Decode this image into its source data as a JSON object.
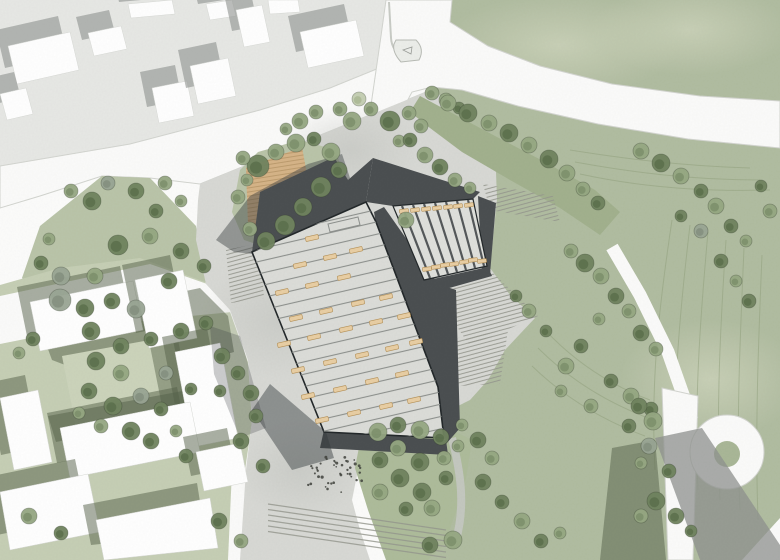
{
  "meta": {
    "description": "Architectural site plan rendering: stepped-roof building with bench-dotted roof terraces, striped courtyard, plazas, lawns, roads, cul-de-sac and context buildings",
    "visible_text": []
  },
  "palette": {
    "bg": "#fcfcfb",
    "block": "#e7e8e5",
    "road": "#fbfbfa",
    "road_edge": "#d3d5d0",
    "plaza": "#d8d9d5",
    "lawn": "#b1bda1",
    "park": "#bac5a9",
    "grass_low": "#c6cfb5",
    "court_grass": "#ccd4bb",
    "berm": "#a2b18e",
    "island": "#aebc9b",
    "building_white": "#ffffff",
    "building_edge": "#d8dad6",
    "shadow_pave": "#8f928f",
    "shadow_grass": "#556149",
    "wall_dark": "#4b4f51",
    "wall_shadow": "#34393b",
    "roof": "#dcddd9",
    "roof_line": "#8e918e",
    "court_floor": "#dfe0dc",
    "stripe": "#54585a",
    "bench": "#e9cfa4",
    "bench_edge": "#b69157",
    "deck": "#d6b488",
    "deck_line": "#bd9c6e",
    "steps_line": "#95978e",
    "contour": "#93a27f",
    "culdesac_center": "#a9b797",
    "dots": "#3f423c",
    "path_gray": "#c6c9c3",
    "outline": "#23282a",
    "tree": [
      "#c4ceb2",
      "#96a883",
      "#70845f",
      "#9aa695"
    ],
    "tree_core": [
      "#aab893",
      "#7c8f6a",
      "#5a6e4b",
      "#838f7e"
    ]
  },
  "context_buildings": {
    "top": [
      "8,46 70,32 79,70 17,84",
      "0,94 26,88 33,114 7,120",
      "88,33 121,26 127,49 94,56",
      "128,4 172,0 175,14 131,18",
      "152,88 187,81 194,116 159,123",
      "190,66 228,58 236,96 198,104",
      "206,4 232,0 236,16 210,20",
      "236,10 262,5 270,42 244,47",
      "300,32 356,20 364,56 308,68",
      "268,0 298,0 300,12 270,14"
    ],
    "bottom": [
      "30,302 133,281 143,330 40,351",
      "135,280 183,270 197,338 149,348",
      "175,352 220,343 238,438 193,447",
      "60,428 190,402 200,452 70,478",
      "196,452 240,443 248,482 204,491",
      "0,398 38,390 52,462 14,470",
      "0,492 88,474 100,532 10,550",
      "96,520 210,498 218,548 104,560"
    ]
  },
  "courtyard_stripes": [
    [
      402,
      206,
      430,
      278
    ],
    [
      413,
      205,
      439,
      276
    ],
    [
      424,
      204,
      448,
      274
    ],
    [
      435,
      203,
      457,
      272
    ],
    [
      446,
      202,
      466,
      270
    ],
    [
      457,
      201,
      475,
      268
    ],
    [
      468,
      200,
      484,
      266
    ]
  ],
  "courtyard_benches": [
    [
      404,
      211
    ],
    [
      427,
      269
    ],
    [
      415,
      210
    ],
    [
      436,
      267
    ],
    [
      426,
      209
    ],
    [
      445,
      265
    ],
    [
      437,
      208
    ],
    [
      454,
      264
    ],
    [
      448,
      207
    ],
    [
      464,
      262
    ],
    [
      458,
      206
    ],
    [
      473,
      260
    ],
    [
      469,
      205
    ],
    [
      482,
      261
    ]
  ],
  "roof_benches": [
    [
      300,
      265
    ],
    [
      330,
      257
    ],
    [
      356,
      250
    ],
    [
      282,
      292
    ],
    [
      312,
      285
    ],
    [
      344,
      277
    ],
    [
      296,
      318
    ],
    [
      326,
      311
    ],
    [
      358,
      303
    ],
    [
      386,
      297
    ],
    [
      284,
      344
    ],
    [
      314,
      337
    ],
    [
      346,
      329
    ],
    [
      376,
      322
    ],
    [
      404,
      316
    ],
    [
      298,
      370
    ],
    [
      330,
      362
    ],
    [
      362,
      355
    ],
    [
      392,
      348
    ],
    [
      416,
      342
    ],
    [
      308,
      396
    ],
    [
      340,
      389
    ],
    [
      372,
      381
    ],
    [
      402,
      374
    ],
    [
      322,
      420
    ],
    [
      354,
      413
    ],
    [
      386,
      406
    ],
    [
      414,
      400
    ],
    [
      312,
      238
    ]
  ],
  "dots": {
    "cx": 332,
    "cy": 474,
    "rx": 34,
    "ry": 20,
    "count": 42,
    "seed": 7
  },
  "trees": [
    [
      258,
      166,
      11,
      2
    ],
    [
      243,
      158,
      7,
      1
    ],
    [
      276,
      152,
      8,
      1
    ],
    [
      296,
      143,
      9,
      1
    ],
    [
      314,
      139,
      7,
      2
    ],
    [
      331,
      152,
      9,
      1
    ],
    [
      339,
      170,
      8,
      2
    ],
    [
      321,
      187,
      10,
      2
    ],
    [
      303,
      207,
      9,
      2
    ],
    [
      285,
      225,
      10,
      2
    ],
    [
      266,
      241,
      9,
      2
    ],
    [
      250,
      229,
      7,
      1
    ],
    [
      238,
      197,
      7,
      1
    ],
    [
      247,
      180,
      6,
      1
    ],
    [
      352,
      121,
      9,
      1
    ],
    [
      371,
      109,
      7,
      1
    ],
    [
      390,
      121,
      10,
      2
    ],
    [
      409,
      113,
      7,
      1
    ],
    [
      421,
      126,
      7,
      1
    ],
    [
      399,
      141,
      6,
      1
    ],
    [
      359,
      99,
      7,
      0
    ],
    [
      340,
      109,
      7,
      1
    ],
    [
      300,
      121,
      8,
      1
    ],
    [
      286,
      129,
      6,
      1
    ],
    [
      316,
      112,
      7,
      1
    ],
    [
      410,
      140,
      7,
      2
    ],
    [
      425,
      155,
      8,
      1
    ],
    [
      440,
      167,
      8,
      2
    ],
    [
      455,
      180,
      7,
      1
    ],
    [
      470,
      188,
      6,
      1
    ],
    [
      446,
      100,
      7,
      1
    ],
    [
      459,
      108,
      6,
      2
    ],
    [
      406,
      220,
      8,
      1
    ],
    [
      448,
      103,
      8,
      1
    ],
    [
      468,
      113,
      9,
      2
    ],
    [
      489,
      123,
      8,
      1
    ],
    [
      509,
      133,
      9,
      2
    ],
    [
      529,
      145,
      8,
      1
    ],
    [
      549,
      159,
      9,
      2
    ],
    [
      567,
      173,
      8,
      1
    ],
    [
      583,
      189,
      7,
      1
    ],
    [
      432,
      93,
      7,
      1
    ],
    [
      598,
      203,
      7,
      2
    ],
    [
      60,
      300,
      11,
      3
    ],
    [
      85,
      308,
      9,
      2
    ],
    [
      112,
      301,
      8,
      2
    ],
    [
      136,
      309,
      9,
      3
    ],
    [
      95,
      276,
      8,
      1
    ],
    [
      61,
      276,
      9,
      3
    ],
    [
      41,
      263,
      7,
      2
    ],
    [
      118,
      245,
      10,
      2
    ],
    [
      150,
      236,
      8,
      1
    ],
    [
      92,
      201,
      9,
      2
    ],
    [
      71,
      191,
      7,
      1
    ],
    [
      108,
      183,
      7,
      3
    ],
    [
      136,
      191,
      8,
      2
    ],
    [
      165,
      183,
      7,
      1
    ],
    [
      181,
      201,
      6,
      1
    ],
    [
      49,
      239,
      6,
      1
    ],
    [
      156,
      211,
      7,
      2
    ],
    [
      181,
      251,
      8,
      2
    ],
    [
      204,
      266,
      7,
      2
    ],
    [
      169,
      281,
      8,
      2
    ],
    [
      91,
      331,
      9,
      2
    ],
    [
      121,
      346,
      8,
      2
    ],
    [
      151,
      339,
      7,
      2
    ],
    [
      181,
      331,
      8,
      2
    ],
    [
      206,
      323,
      7,
      2
    ],
    [
      222,
      356,
      8,
      2
    ],
    [
      238,
      373,
      7,
      2
    ],
    [
      220,
      391,
      6,
      2
    ],
    [
      96,
      361,
      9,
      2
    ],
    [
      121,
      373,
      8,
      1
    ],
    [
      89,
      391,
      8,
      2
    ],
    [
      113,
      406,
      9,
      2
    ],
    [
      141,
      396,
      8,
      3
    ],
    [
      161,
      409,
      7,
      2
    ],
    [
      131,
      431,
      9,
      2
    ],
    [
      101,
      426,
      7,
      1
    ],
    [
      151,
      441,
      8,
      2
    ],
    [
      176,
      431,
      6,
      1
    ],
    [
      186,
      456,
      7,
      2
    ],
    [
      79,
      413,
      6,
      1
    ],
    [
      166,
      373,
      7,
      3
    ],
    [
      191,
      389,
      6,
      2
    ],
    [
      33,
      339,
      7,
      2
    ],
    [
      19,
      353,
      6,
      1
    ],
    [
      251,
      393,
      8,
      2
    ],
    [
      256,
      416,
      7,
      2
    ],
    [
      241,
      441,
      8,
      2
    ],
    [
      263,
      466,
      7,
      2
    ],
    [
      29,
      516,
      8,
      1
    ],
    [
      61,
      533,
      7,
      2
    ],
    [
      219,
      521,
      8,
      2
    ],
    [
      241,
      541,
      7,
      1
    ],
    [
      378,
      432,
      9,
      1
    ],
    [
      398,
      425,
      8,
      2
    ],
    [
      420,
      430,
      9,
      1
    ],
    [
      441,
      437,
      8,
      2
    ],
    [
      398,
      448,
      8,
      1
    ],
    [
      380,
      460,
      8,
      2
    ],
    [
      420,
      462,
      9,
      2
    ],
    [
      444,
      458,
      7,
      1
    ],
    [
      400,
      478,
      9,
      2
    ],
    [
      380,
      492,
      8,
      1
    ],
    [
      422,
      492,
      9,
      2
    ],
    [
      446,
      478,
      7,
      2
    ],
    [
      432,
      508,
      8,
      1
    ],
    [
      406,
      509,
      7,
      2
    ],
    [
      458,
      446,
      6,
      1
    ],
    [
      462,
      425,
      6,
      1
    ],
    [
      453,
      540,
      9,
      1
    ],
    [
      430,
      545,
      8,
      2
    ],
    [
      478,
      440,
      8,
      2
    ],
    [
      492,
      458,
      7,
      1
    ],
    [
      483,
      482,
      8,
      2
    ],
    [
      502,
      502,
      7,
      2
    ],
    [
      522,
      521,
      8,
      1
    ],
    [
      541,
      541,
      7,
      2
    ],
    [
      560,
      533,
      6,
      1
    ],
    [
      585,
      263,
      9,
      2
    ],
    [
      601,
      276,
      8,
      1
    ],
    [
      571,
      251,
      7,
      1
    ],
    [
      616,
      296,
      8,
      2
    ],
    [
      629,
      311,
      7,
      1
    ],
    [
      599,
      319,
      6,
      1
    ],
    [
      641,
      333,
      8,
      2
    ],
    [
      656,
      349,
      7,
      1
    ],
    [
      581,
      346,
      7,
      2
    ],
    [
      566,
      366,
      8,
      1
    ],
    [
      611,
      381,
      7,
      2
    ],
    [
      631,
      396,
      8,
      1
    ],
    [
      651,
      409,
      7,
      2
    ],
    [
      561,
      391,
      6,
      1
    ],
    [
      591,
      406,
      7,
      1
    ],
    [
      546,
      331,
      6,
      2
    ],
    [
      529,
      311,
      7,
      1
    ],
    [
      516,
      296,
      6,
      2
    ],
    [
      641,
      151,
      8,
      1
    ],
    [
      661,
      163,
      9,
      2
    ],
    [
      681,
      176,
      8,
      1
    ],
    [
      701,
      191,
      7,
      2
    ],
    [
      716,
      206,
      8,
      1
    ],
    [
      731,
      226,
      7,
      2
    ],
    [
      746,
      241,
      6,
      1
    ],
    [
      701,
      231,
      7,
      3
    ],
    [
      681,
      216,
      6,
      2
    ],
    [
      721,
      261,
      7,
      2
    ],
    [
      736,
      281,
      6,
      1
    ],
    [
      749,
      301,
      7,
      2
    ],
    [
      770,
      211,
      7,
      1
    ],
    [
      761,
      186,
      6,
      2
    ],
    [
      639,
      406,
      8,
      2
    ],
    [
      653,
      421,
      9,
      1
    ],
    [
      629,
      426,
      7,
      2
    ],
    [
      649,
      446,
      8,
      3
    ],
    [
      669,
      471,
      7,
      2
    ],
    [
      641,
      463,
      6,
      1
    ],
    [
      656,
      501,
      9,
      2
    ],
    [
      676,
      516,
      8,
      2
    ],
    [
      641,
      516,
      7,
      1
    ],
    [
      691,
      531,
      6,
      2
    ]
  ]
}
